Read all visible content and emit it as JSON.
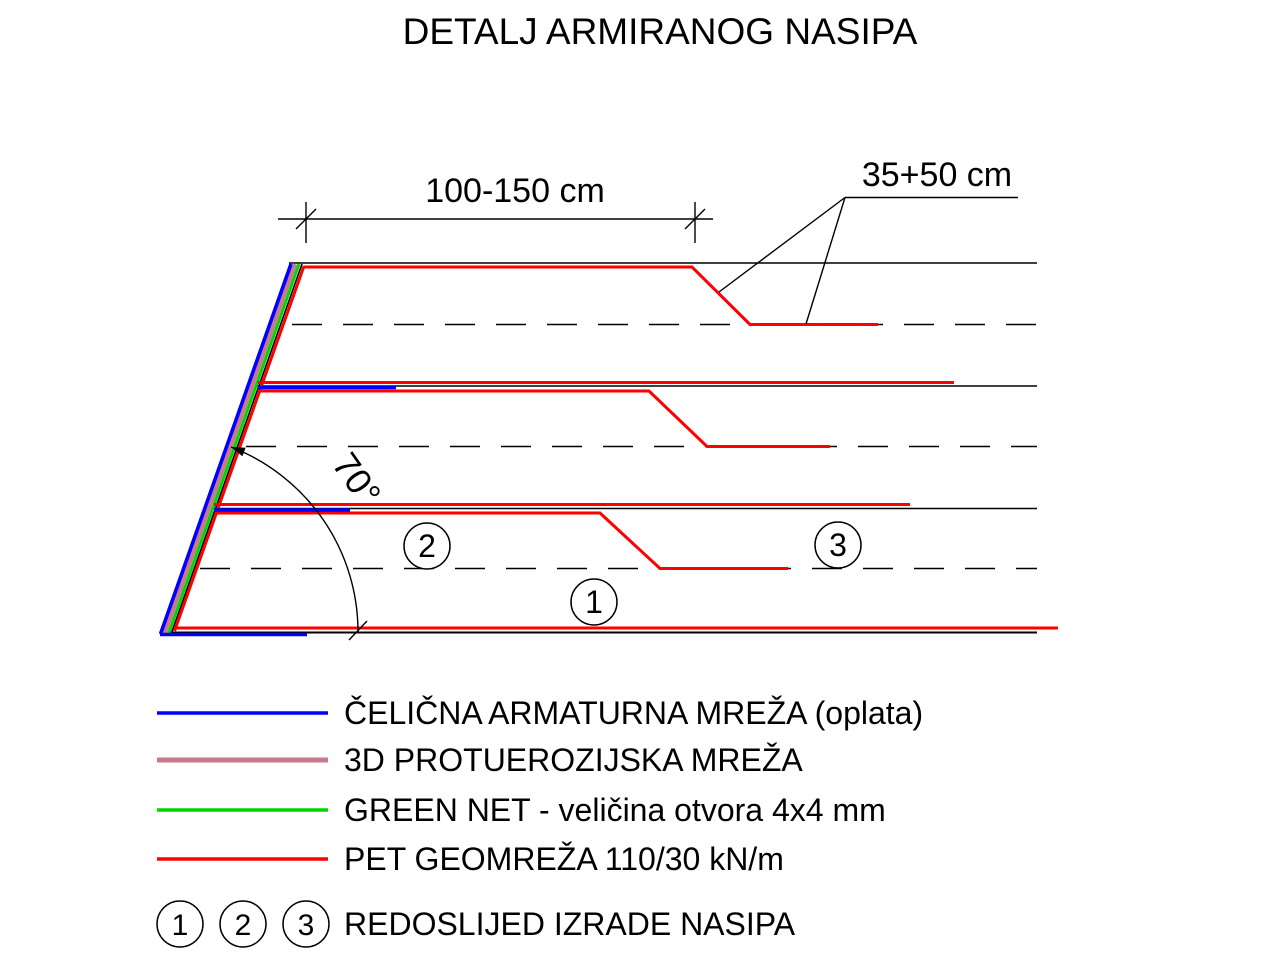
{
  "title": "DETALJ ARMIRANOG NASIPA",
  "annotations": {
    "top_dimension": "100-150 cm",
    "anchor_dimension": "35+50 cm",
    "slope_angle": "70°"
  },
  "sequence_markers": {
    "m1": "1",
    "m2": "2",
    "m3": "3"
  },
  "legend": {
    "items": [
      {
        "name": "steel-reinforcement-mesh",
        "label": "ČELIČNA ARMATURNA MREŽA (oplata)",
        "color": "#0000FF"
      },
      {
        "name": "3d-erosion-control-mesh",
        "label": "3D PROTUEROZIJSKA MREŽA",
        "color": "#C9798E"
      },
      {
        "name": "green-net",
        "label": "GREEN NET - veličina otvora 4x4 mm",
        "color": "#00D500"
      },
      {
        "name": "pet-geogrid",
        "label": "PET GEOMREŽA 110/30 kN/m",
        "color": "#FF0000"
      }
    ],
    "sequence": {
      "numbers": [
        "1",
        "2",
        "3"
      ],
      "label": "REDOSLIJED IZRADE NASIPA"
    }
  },
  "colors": {
    "drawing_black": "#000000",
    "background": "#FFFFFF",
    "steel_mesh_blue": "#0000FF",
    "erosion_mesh_pink": "#C9798E",
    "green_net_green": "#00D500",
    "geogrid_red": "#FF0000"
  }
}
